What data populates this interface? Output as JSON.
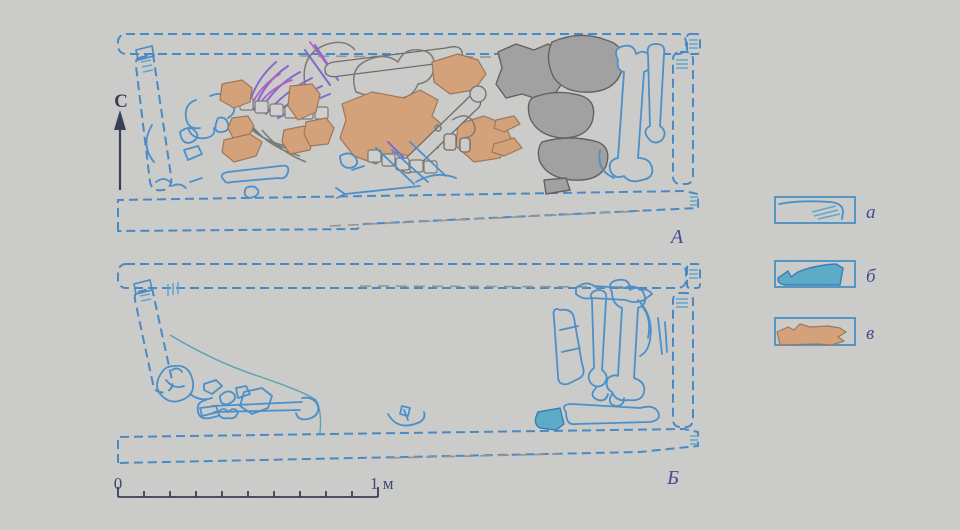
{
  "figure": {
    "type": "archaeological-burial-plan",
    "north_label": "С",
    "plan_a_label": "А",
    "plan_b_label": "Б"
  },
  "legend": {
    "items": [
      {
        "label": "а",
        "swatch": "outlined-plank-drawing",
        "color": "#2d7ec7"
      },
      {
        "label": "б",
        "swatch": "blue-filled-object",
        "color": "#44a9cd"
      },
      {
        "label": "в",
        "swatch": "orange-filled-object",
        "color": "#dd9e6a"
      }
    ]
  },
  "scale_bar": {
    "zero_label": "0",
    "end_label": "1 м",
    "divisions": 10
  },
  "colors": {
    "background": "#d3d3d1",
    "coffin_outline_blue": "#2d7ec7",
    "bone_outline_blue": "#2f86cf",
    "rib_purple": "#7a52d4",
    "rib_magenta": "#b848c8",
    "fill_orange": "#dd9e6a",
    "fill_gray": "#9d9d9b",
    "fill_teal": "#44a9cd",
    "label_navy": "#25317f"
  }
}
